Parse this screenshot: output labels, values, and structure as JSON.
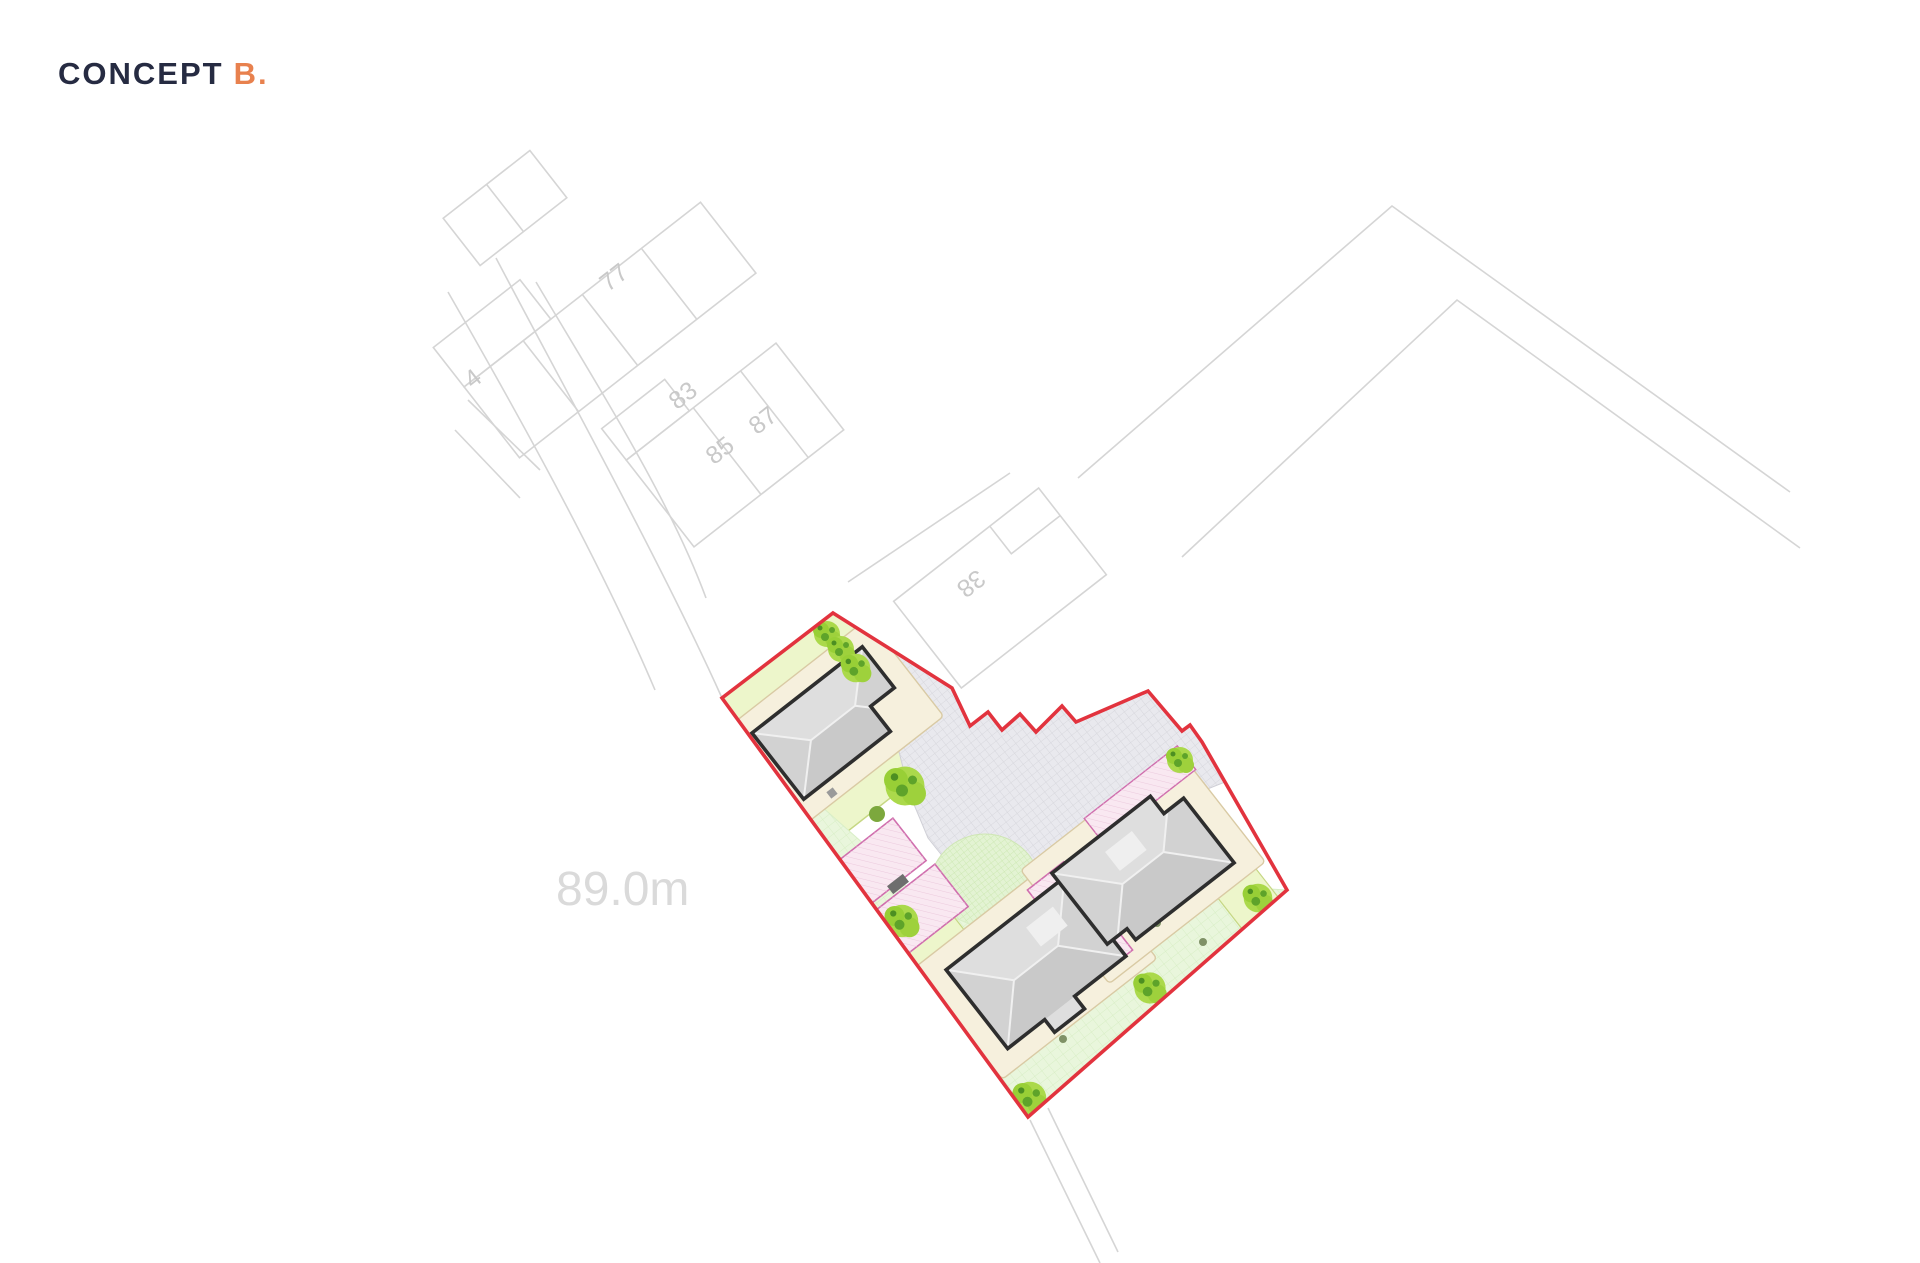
{
  "title": {
    "main": "CONCEPT",
    "variant": "B."
  },
  "annotations": {
    "spot_level": "89.0m"
  },
  "house_numbers": {
    "n4": "4",
    "n77": "77",
    "n83": "83",
    "n85": "85",
    "n87": "87",
    "n38": "38"
  },
  "colors": {
    "title_text": "#262b42",
    "title_accent": "#e8814e",
    "site_boundary": "#e2333e",
    "map_linework": "#d5d5d5",
    "map_label": "#c9c9c9",
    "spot_level_text": "#dadada",
    "garden_green": "#edf6cb",
    "garden_edge": "#c6d783",
    "lawn_green": "#e9f6dc",
    "lawn_hatch": "#d4ecc0",
    "circle_lawn": "#e3f3d3",
    "circle_hatch": "#c9e6ad",
    "driveway": "#e9e9ee",
    "driveway_hatch": "#d6d6dc",
    "path_cream": "#f6f0dd",
    "path_cream_edge": "#d9caa4",
    "patio_pink": "#f9e8f1",
    "patio_pink_edge": "#d06fae",
    "house_outline": "#2e2e2e",
    "roof_light": "#dedede",
    "roof_dark": "#cbcbcb",
    "tree_green": "#abd94b",
    "tree_dark": "#5ea32a"
  }
}
